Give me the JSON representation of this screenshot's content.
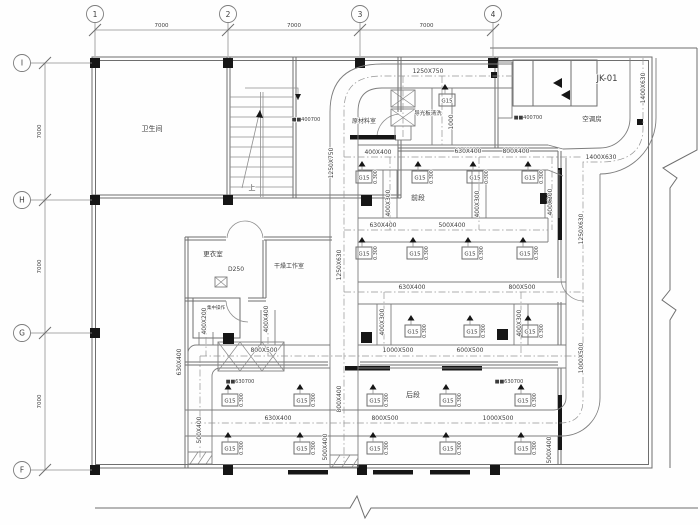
{
  "drawing": {
    "grid": {
      "cols": [
        {
          "label": "1",
          "x": 95
        },
        {
          "label": "2",
          "x": 228
        },
        {
          "label": "3",
          "x": 360
        },
        {
          "label": "4",
          "x": 493
        }
      ],
      "rows": [
        {
          "label": "I",
          "y": 63
        },
        {
          "label": "H",
          "y": 200
        },
        {
          "label": "G",
          "y": 333
        },
        {
          "label": "F",
          "y": 470
        }
      ],
      "col_dims": [
        "7000",
        "7000",
        "7000"
      ],
      "row_dims": [
        "7000",
        "7000",
        "7000"
      ]
    },
    "rooms": [
      {
        "label": "卫生间",
        "x": 152,
        "y": 131,
        "s": 7
      },
      {
        "label": "原材料室",
        "x": 364,
        "y": 123,
        "s": 6
      },
      {
        "label": "导光板清洗",
        "x": 428,
        "y": 115,
        "s": 5.5
      },
      {
        "label": "空调房",
        "x": 592,
        "y": 121,
        "s": 6.5
      },
      {
        "label": "更衣室",
        "x": 213,
        "y": 256,
        "s": 6.5
      },
      {
        "label": "干燥工作室",
        "x": 289,
        "y": 268,
        "s": 6
      },
      {
        "label": "集中操作",
        "x": 216,
        "y": 309,
        "s": 4.5
      },
      {
        "label": "前段",
        "x": 418,
        "y": 200,
        "s": 7
      },
      {
        "label": "后段",
        "x": 413,
        "y": 397,
        "s": 7
      },
      {
        "label": "上",
        "x": 252,
        "y": 190,
        "s": 7
      }
    ],
    "equipment": [
      {
        "label": "JK-01",
        "x": 607,
        "y": 81,
        "s": 8.5
      }
    ],
    "duct_labels_h": [
      {
        "t": "1250X750",
        "x": 428,
        "y": 73
      },
      {
        "t": "1400X630",
        "x": 601,
        "y": 159
      },
      {
        "t": "400X400",
        "x": 378,
        "y": 154
      },
      {
        "t": "630X400",
        "x": 468,
        "y": 153
      },
      {
        "t": "800X400",
        "x": 516,
        "y": 153
      },
      {
        "t": "630X400",
        "x": 383,
        "y": 227
      },
      {
        "t": "500X400",
        "x": 452,
        "y": 227
      },
      {
        "t": "630X400",
        "x": 412,
        "y": 289
      },
      {
        "t": "800X500",
        "x": 522,
        "y": 289
      },
      {
        "t": "800X500",
        "x": 264,
        "y": 352
      },
      {
        "t": "1000X500",
        "x": 398,
        "y": 352
      },
      {
        "t": "600X500",
        "x": 470,
        "y": 352
      },
      {
        "t": "630X400",
        "x": 278,
        "y": 420
      },
      {
        "t": "800X500",
        "x": 385,
        "y": 420
      },
      {
        "t": "1000X500",
        "x": 498,
        "y": 420
      },
      {
        "t": "D250",
        "x": 236,
        "y": 271
      }
    ],
    "duct_labels_v": [
      {
        "t": "1250X750",
        "x": 333,
        "y": 163
      },
      {
        "t": "1250X630",
        "x": 341,
        "y": 265
      },
      {
        "t": "800X400",
        "x": 341,
        "y": 399
      },
      {
        "t": "500X400",
        "x": 327,
        "y": 447
      },
      {
        "t": "1250X630",
        "x": 583,
        "y": 229
      },
      {
        "t": "1000X500",
        "x": 583,
        "y": 358
      },
      {
        "t": "1400X630",
        "x": 645,
        "y": 88
      },
      {
        "t": "400X300",
        "x": 390,
        "y": 203
      },
      {
        "t": "400X300",
        "x": 479,
        "y": 204
      },
      {
        "t": "400X300",
        "x": 552,
        "y": 202
      },
      {
        "t": "400X300",
        "x": 384,
        "y": 322
      },
      {
        "t": "400X300",
        "x": 521,
        "y": 323
      },
      {
        "t": "400X200",
        "x": 206,
        "y": 321
      },
      {
        "t": "400X400",
        "x": 268,
        "y": 319
      },
      {
        "t": "630X400",
        "x": 181,
        "y": 362
      },
      {
        "t": "500X400",
        "x": 201,
        "y": 430
      },
      {
        "t": "500X400",
        "x": 551,
        "y": 450
      },
      {
        "t": "1000",
        "x": 453,
        "y": 122
      }
    ],
    "grille_labels": [
      {
        "t": "■■400700",
        "x": 306,
        "y": 121
      },
      {
        "t": "■■400700",
        "x": 528,
        "y": 119
      },
      {
        "t": "■■630700",
        "x": 240,
        "y": 383
      },
      {
        "t": "■■630700",
        "x": 509,
        "y": 383
      }
    ],
    "diffuser": {
      "tag": "G15",
      "level": "0.300",
      "positions": [
        [
          364,
          177
        ],
        [
          420,
          177
        ],
        [
          475,
          177
        ],
        [
          530,
          177
        ],
        [
          364,
          253
        ],
        [
          415,
          253
        ],
        [
          470,
          253
        ],
        [
          525,
          253
        ],
        [
          413,
          331
        ],
        [
          472,
          331
        ],
        [
          530,
          331
        ],
        [
          230,
          400
        ],
        [
          302,
          400
        ],
        [
          375,
          400
        ],
        [
          448,
          400
        ],
        [
          523,
          400
        ],
        [
          230,
          448
        ],
        [
          302,
          448
        ],
        [
          375,
          448
        ],
        [
          448,
          448
        ],
        [
          523,
          448
        ]
      ],
      "extra": [
        [
          447,
          100
        ]
      ]
    }
  }
}
